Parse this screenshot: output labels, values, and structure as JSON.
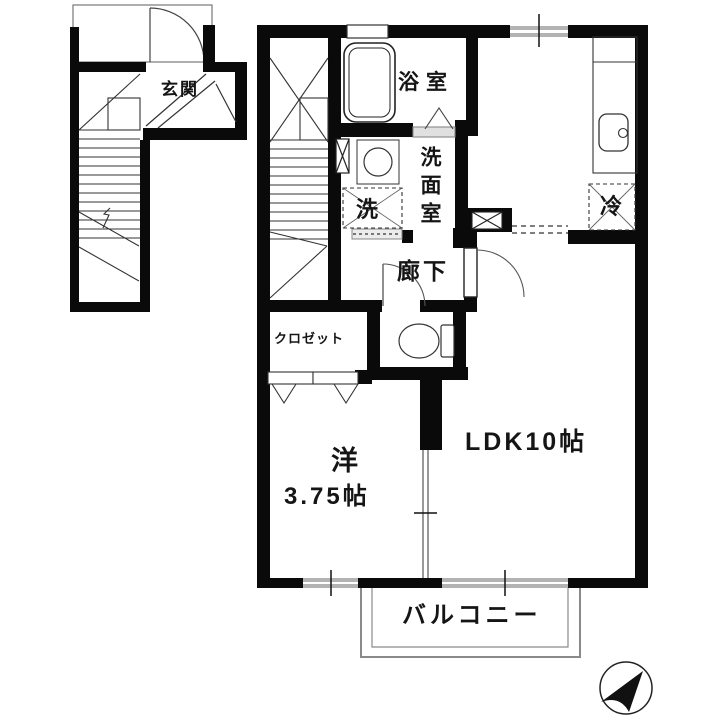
{
  "page": {
    "width": 720,
    "height": 720,
    "background": "#ffffff"
  },
  "colors": {
    "wall": "#0a0a0a",
    "thin_line": "#333333",
    "window_gray": "#b3b3b3",
    "balcony_line": "#8a8a8a",
    "dashed_line": "#555555"
  },
  "rooms": {
    "entrance": "玄関",
    "bathroom": "浴室",
    "washroom": "洗面室",
    "laundry": "洗",
    "refrigerator": "冷",
    "hallway": "廊下",
    "closet": "クロゼット",
    "western_room_name": "洋",
    "western_room_size": "3.75帖",
    "ldk": "LDK10帖",
    "balcony": "バルコニー"
  },
  "icons": {
    "compass": "north-arrow-upper-right",
    "bathtub": "bathtub",
    "toilet": "toilet-with-tank",
    "washroom_sink": "round-basin",
    "kitchen_sink": "counter-with-sink",
    "stairs": "staircase-flights"
  }
}
